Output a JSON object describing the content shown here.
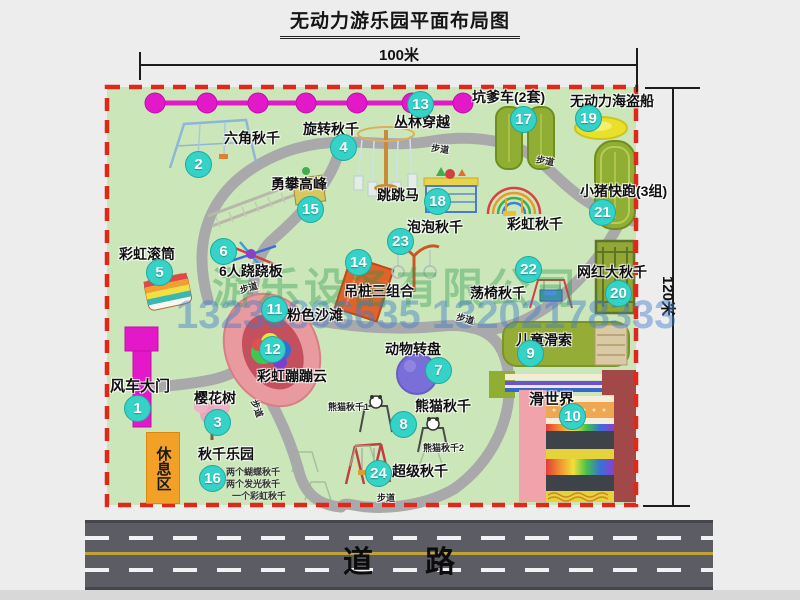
{
  "title": "无动力游乐园平面布局图",
  "dimensions": {
    "width": "100米",
    "height": "120米"
  },
  "road": {
    "label": "道路"
  },
  "rest_area": {
    "label": "休息区"
  },
  "path_label": "步道",
  "watermark": {
    "company": "游乐设备有限公司",
    "phone": "13233806635 13202178333"
  },
  "extra_labels": {
    "rainbow_swing": "彩虹秋千",
    "panda_swing_1": "熊猫秋千1",
    "panda_swing_2": "熊猫秋千2"
  },
  "attractions": [
    {
      "num": "1",
      "label": "风车大门"
    },
    {
      "num": "2",
      "label": "六角秋千"
    },
    {
      "num": "3",
      "label": "樱花树"
    },
    {
      "num": "4",
      "label": "旋转秋千"
    },
    {
      "num": "5",
      "label": "彩虹滚筒"
    },
    {
      "num": "6",
      "label": "6人跷跷板"
    },
    {
      "num": "7",
      "label": "动物转盘"
    },
    {
      "num": "8",
      "label": "熊猫秋千"
    },
    {
      "num": "9",
      "label": "儿童滑索"
    },
    {
      "num": "10",
      "label": "滑世界"
    },
    {
      "num": "11",
      "label": "粉色沙滩"
    },
    {
      "num": "12",
      "label": "彩虹蹦蹦云"
    },
    {
      "num": "13",
      "label": "丛林穿越"
    },
    {
      "num": "14",
      "label": "吊桩三组合"
    },
    {
      "num": "15",
      "label": "勇攀高峰"
    },
    {
      "num": "16",
      "label": "秋千乐园",
      "details": [
        "两个蝴蝶秋千",
        "两个发光秋千",
        "一个彩虹秋千"
      ]
    },
    {
      "num": "17",
      "label": "坑爹车(2套)"
    },
    {
      "num": "18",
      "label": "跳跳马"
    },
    {
      "num": "19",
      "label": "无动力海盗船"
    },
    {
      "num": "20",
      "label": "网红大秋千"
    },
    {
      "num": "21",
      "label": "小猪快跑(3组)"
    },
    {
      "num": "22",
      "label": "荡椅秋千"
    },
    {
      "num": "23",
      "label": "泡泡秋千"
    },
    {
      "num": "24",
      "label": "超级秋千"
    }
  ],
  "colors": {
    "map_green": "#cbe7ba",
    "border_red": "#e0281a",
    "badge_teal": "#35d2c7",
    "zipline_magenta": "#e318c8",
    "path_gray": "#a9a9ac",
    "road_gray": "#5c5c65",
    "rest_orange": "#f2a126"
  }
}
